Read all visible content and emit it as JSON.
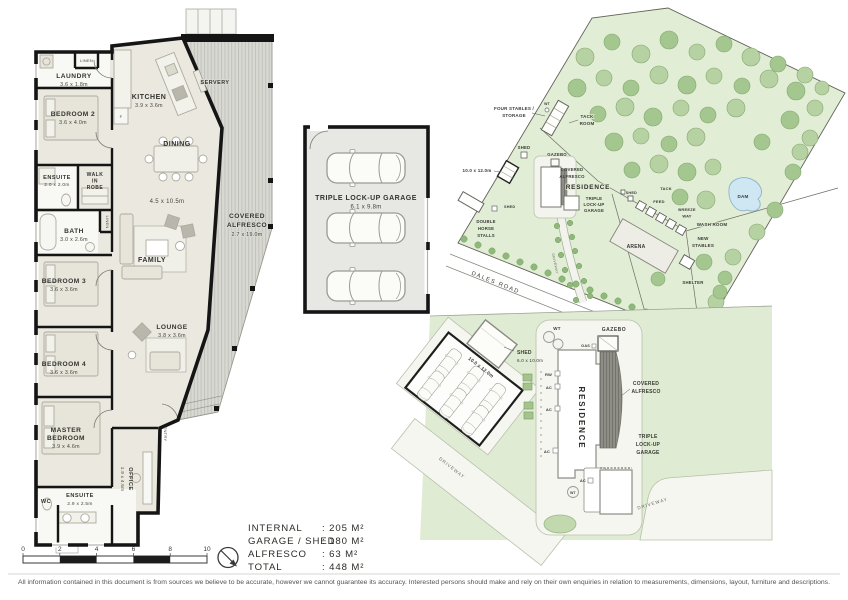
{
  "floor_plan": {
    "laundry": {
      "name": "LAUNDRY",
      "dims": "3.6 x 1.8m"
    },
    "linen": "LINEN",
    "bedroom2": {
      "name": "BEDROOM 2",
      "dims": "3.6 x 4.0m"
    },
    "ensuite2": {
      "name": "ENSUITE",
      "dims": "2.0 x 2.0m"
    },
    "wir": {
      "l1": "WALK",
      "l2": "IN",
      "l3": "ROBE"
    },
    "bath": {
      "name": "BATH",
      "dims": "3.0 x 2.6m"
    },
    "bedroom3": {
      "name": "BEDROOM 3",
      "dims": "3.6 x 3.6m"
    },
    "bedroom4": {
      "name": "BEDROOM 4",
      "dims": "3.6 x 3.6m"
    },
    "master": {
      "l1": "MASTER",
      "l2": "BEDROOM",
      "dims": "3.9 x 4.6m"
    },
    "wc": "WC",
    "ensuite_master": {
      "name": "ENSUITE",
      "dims": "2.9 x 2.5m"
    },
    "kitchen": {
      "name": "KITCHEN",
      "dims": "3.9 x 3.6m"
    },
    "fridge": "F",
    "servery": "SERVERY",
    "dining": "DINING",
    "family": {
      "name": "FAMILY",
      "dims": "4.5 x 10.5m"
    },
    "lounge": {
      "name": "LOUNGE",
      "dims": "3.8 x 3.6m"
    },
    "entry": "ENTRY",
    "office": {
      "name": "OFFICE",
      "dims": "1.9 x 4.5m"
    },
    "alfresco": {
      "l1": "COVERED",
      "l2": "ALFRESCO",
      "dims": "2.7 x 19.0m"
    }
  },
  "garage_plan": {
    "name": "TRIPLE LOCK-UP GARAGE",
    "dims": "6.1 x 9.8m"
  },
  "site_plan": {
    "wt": "WT",
    "four_stables": {
      "l1": "FOUR STABLES /",
      "l2": "STORAGE"
    },
    "tack_room": {
      "l1": "TACK",
      "l2": "ROOM"
    },
    "shed_upper": "SHED",
    "carport_dims": "10.0 x 12.0m",
    "gazebo": "GAZEBO",
    "alfresco": {
      "l1": "COVERED",
      "l2": "ALFRESCO"
    },
    "residence": "RESIDENCE",
    "garage": {
      "l1": "TRIPLE",
      "l2": "LOCK-UP",
      "l3": "GARAGE"
    },
    "shed_small": "SHED",
    "tack": "TACK",
    "feed": "FEED",
    "breeze_way": {
      "l1": "BREEZE",
      "l2": "WAY"
    },
    "wash_room": "WASH ROOM",
    "new_stables": {
      "l1": "NEW",
      "l2": "STABLES"
    },
    "arena": "ARENA",
    "shelter": "SHELTER",
    "dam": "DAM",
    "double_horse_stalls": {
      "l1": "DOUBLE",
      "l2": "HORSE",
      "l3": "STALLS"
    },
    "shed_lower": "SHED",
    "dales_road": "DALES ROAD",
    "driveway": "DRIVEWAY"
  },
  "site_closeup": {
    "wt": "WT",
    "gazebo": "GAZEBO",
    "gas": "GAS",
    "shed": {
      "name": "SHED",
      "dims": "6.0 x 10.0m"
    },
    "carport_dims": "10.0 x 12.0m",
    "rw": "RW",
    "ac": "AC",
    "residence": "RESIDENCE",
    "alfresco": {
      "l1": "COVERED",
      "l2": "ALFRESCO"
    },
    "garage": {
      "l1": "TRIPLE",
      "l2": "LOCK-UP",
      "l3": "GARAGE"
    },
    "driveway": "DRIVEWAY"
  },
  "legend": {
    "rows": [
      {
        "label": "INTERNAL",
        "value": ": 205 M²"
      },
      {
        "label": "GARAGE / SHED",
        "value": ": 180 M²"
      },
      {
        "label": "ALFRESCO",
        "value": ": 63 M²"
      },
      {
        "label": "TOTAL",
        "value": ": 448 M²"
      }
    ]
  },
  "scale_bar": {
    "ticks": [
      "0",
      "2",
      "4",
      "6",
      "8",
      "10"
    ]
  },
  "disclaimer": "All information contained in this document is from sources we believe to be accurate, however we cannot guarantee its accuracy. Interested persons should make and rely on their own enquiries in relation to measurements, dimensions, layout, furniture and descriptions.",
  "colors": {
    "wall": "#151515",
    "floor": "#ebe9df",
    "site_green": "#e1edd5",
    "tree": "#a3c78e",
    "dam": "#cfe7f3"
  }
}
